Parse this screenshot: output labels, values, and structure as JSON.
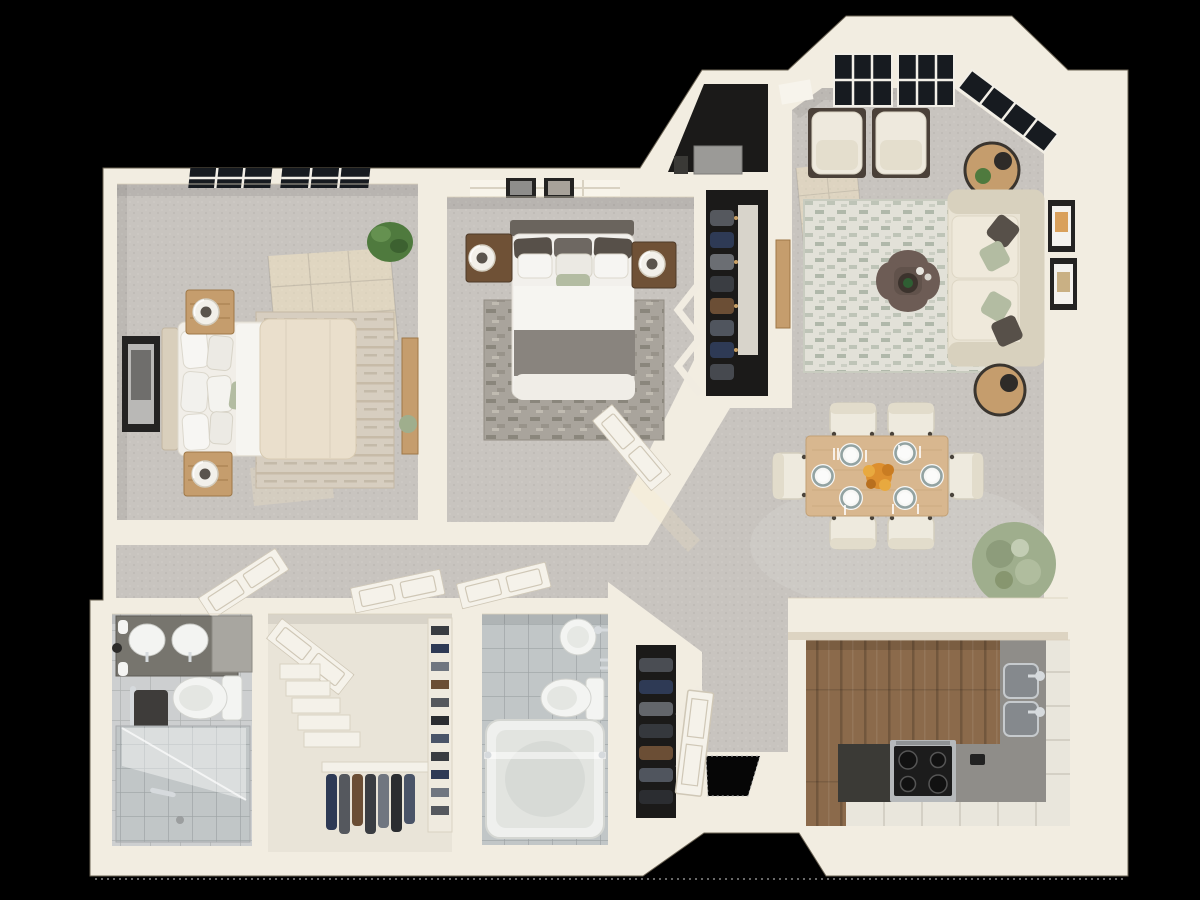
{
  "scene": {
    "type": "3d-floor-plan-render",
    "view": "top-down-dollhouse",
    "background": "#000000",
    "units": "none",
    "visible_text": "none"
  },
  "palette": {
    "bg": "#000000",
    "wall": "#f2ede1",
    "wallShade": "#ddd4c2",
    "wallDeep": "#cfc5b0",
    "carpet": "#c8c4bf",
    "carpetLight": "#d8d4ce",
    "tile": "#cdcfd0",
    "tileLine": "#b0b3b3",
    "tile2": "#c1c6c7",
    "tile2Line": "#9ca2a4",
    "wood": "#8b6a4b",
    "woodDark": "#6e5238",
    "closet": "#1b1a19",
    "door": "#f5f2ea",
    "doorLine": "#cfc7b6",
    "glass": "#171b20",
    "mullion": "#f2efe7",
    "duvet": "#eadfcc",
    "sheet": "#f6f5f1",
    "blanket": "#89847e",
    "sage": "#b3bca2",
    "pillowDark": "#575049",
    "headboard": "#6a645d",
    "woodLight": "#c59d6d",
    "woodNight": "#6f5136",
    "sofa": "#e9e3d4",
    "sofaShade": "#d8d1be",
    "ottoman": "#6d5c55",
    "rugBeige": "#d7cec0",
    "rugGrey": "#a9a49c",
    "rugBase": "#e2e1d8",
    "rugBlock": "#a7b1a2",
    "table": "#d8b78f",
    "chair": "#eeeade",
    "plateRing": "#93a3a2",
    "flower": "#dd8f2e",
    "counterDark": "#3b3a36",
    "counterGrey": "#8f8d89",
    "stove": "#1c1c1c",
    "steel": "#b6b9bb",
    "chrome": "#d6dadd",
    "cabinet": "#e9e6dc",
    "fixture": "#f3f4f2",
    "towel": "#3e3c3a",
    "plant": "#4f7a3e",
    "plantSage": "#9fae8d",
    "frame": "#242322",
    "sun": "#ffedc4",
    "pot": "#33312e",
    "boxGrey": "#9b9a97"
  },
  "rooms": [
    {
      "id": "master-bedroom",
      "furniture": [
        "bed-with-cream-duvet",
        "headboard",
        "nightstand-crate",
        "nightstand-crate",
        "ring-lamp",
        "ring-lamp",
        "framed-wall-art",
        "beige-area-rug",
        "side-dresser",
        "potted-plant",
        "skylight-window",
        "sunlight-patch"
      ]
    },
    {
      "id": "bedroom-2",
      "furniture": [
        "bed-grey-band",
        "dark-headboard",
        "nightstand",
        "nightstand",
        "ring-lamp",
        "ring-lamp",
        "grey-area-rug",
        "bifold-closet-doors",
        "picture-frames",
        "open-door"
      ]
    },
    {
      "id": "bedroom-2-closet",
      "furniture": [
        "hanging-clothes",
        "shelf-board"
      ]
    },
    {
      "id": "utility-closet",
      "furniture": [
        "hvac-unit"
      ]
    },
    {
      "id": "living-room",
      "furniture": [
        "cream-sofa",
        "accent-chair",
        "accent-chair",
        "quatrefoil-ottoman",
        "round-side-table",
        "round-side-table",
        "table-lamp",
        "table-lamp",
        "sage-area-rug",
        "wall-frames",
        "west-console",
        "bay-windows",
        "sunlight-patch"
      ]
    },
    {
      "id": "dining-area",
      "furniture": [
        "wood-dining-table",
        "dining-chair-x6",
        "place-setting-x6",
        "flower-centerpiece",
        "large-potted-plant"
      ]
    },
    {
      "id": "kitchen",
      "furniture": [
        "breakfast-half-wall",
        "l-shaped-counter",
        "range-stove",
        "double-sink",
        "white-cabinets",
        "dark-counter-section",
        "wood-floor"
      ]
    },
    {
      "id": "entry",
      "furniture": [
        "open-front-door",
        "door-opening",
        "coat-closet",
        "bifold-doors"
      ]
    },
    {
      "id": "hallway",
      "furniture": [
        "open-door",
        "open-door",
        "open-door"
      ]
    },
    {
      "id": "master-bathroom",
      "furniture": [
        "double-vanity",
        "round-sink",
        "round-sink",
        "toilet",
        "walk-in-shower",
        "glass-panel",
        "towel-bar",
        "tile-floor"
      ]
    },
    {
      "id": "walk-in-closet",
      "furniture": [
        "open-door",
        "stepped-shelves",
        "hanging-clothes",
        "shoe-rack"
      ]
    },
    {
      "id": "bathroom-2",
      "furniture": [
        "bathtub",
        "glass-screen",
        "toilet",
        "wall-mounted-sink",
        "tile-floor"
      ]
    }
  ],
  "counts": {
    "bedrooms": 2,
    "bathrooms": 2,
    "dining_seats": 6,
    "place_settings": 6,
    "accent_chairs": 2,
    "open_doors": 7
  }
}
